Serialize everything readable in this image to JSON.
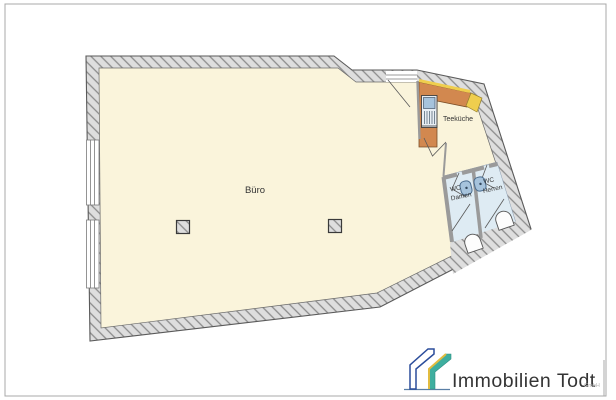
{
  "page": {
    "background": "#FFFFFF",
    "border_color": "#A8A8A8"
  },
  "floorplan": {
    "labels": {
      "office": "Büro",
      "kitchen": "Teeküche",
      "wc_women_1": "WC",
      "wc_women_2": "Damen",
      "wc_men_1": "WC",
      "wc_men_2": "Herren"
    },
    "colors": {
      "floor": "#FAF4DB",
      "wall_base": "#DEDEDE",
      "wall_hatch": "#8C8C8C",
      "wall_outline": "#5A5A5A",
      "wc_floor": "#DEEBF3",
      "counter": "#D2884F",
      "counter_accent": "#EFCE4E",
      "fixture_fill": "#A6C3DC",
      "fixture_outline": "#4A6B8C"
    }
  },
  "logo": {
    "company": "Immobilien Todt",
    "suffix": "GmbH",
    "colors": {
      "blue": "#2B4D9B",
      "teal": "#3EAE9F",
      "yellow": "#E2BC3F",
      "text": "#8D8D8D",
      "suffix_text": "#B5B5B5"
    }
  }
}
